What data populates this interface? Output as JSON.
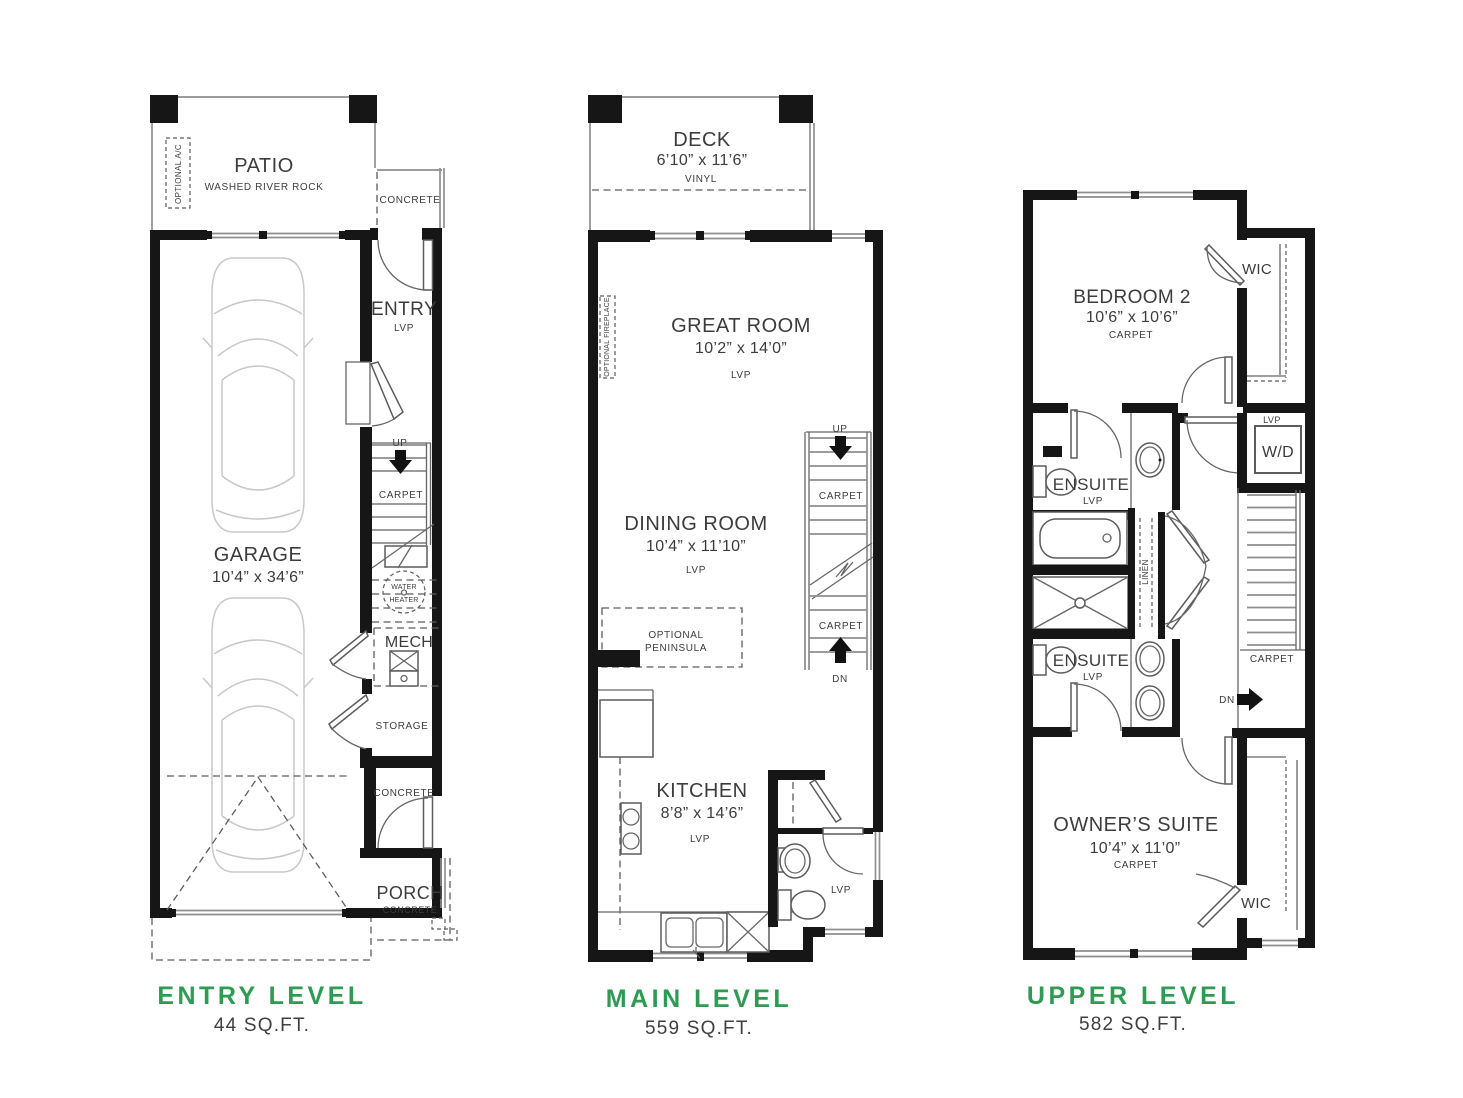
{
  "colors": {
    "accent_green": "#2e9b53",
    "ink": "#3c3c3c",
    "wall": "#161616",
    "thin_line": "#8f8f8f",
    "car_line": "#c8c8c8"
  },
  "entry": {
    "title": "ENTRY LEVEL",
    "area": "44 SQ.FT.",
    "patio": "PATIO",
    "patio_sub": "WASHED RIVER ROCK",
    "optional_ac": "OPTIONAL A/C",
    "concrete1": "CONCRETE",
    "entry": "ENTRY",
    "entry_floor": "LVP",
    "up": "UP",
    "carpet": "CARPET",
    "wh1": "WATER",
    "wh2": "HEATER",
    "mech": "MECH",
    "storage": "STORAGE",
    "garage": "GARAGE",
    "garage_dims": "10’4” x 34’6”",
    "concrete2": "CONCRETE",
    "porch": "PORCH",
    "porch_sub": "CONCRETE"
  },
  "main": {
    "title": "MAIN LEVEL",
    "area": "559 SQ.FT.",
    "deck": "DECK",
    "deck_dims": "6’10” x 11’6”",
    "deck_floor": "VINYL",
    "great": "GREAT ROOM",
    "great_dims": "10’2” x 14’0”",
    "great_floor": "LVP",
    "fireplace": "OPTIONAL FIREPLACE",
    "dining": "DINING ROOM",
    "dining_dims": "10’4” x 11’10”",
    "dining_floor": "LVP",
    "up": "UP",
    "dn": "DN",
    "carpet1": "CARPET",
    "carpet2": "CARPET",
    "pen1": "OPTIONAL",
    "pen2": "PENINSULA",
    "kitchen": "KITCHEN",
    "kitchen_dims": "8’8” x 14’6”",
    "kitchen_floor": "LVP",
    "powder_floor": "LVP"
  },
  "upper": {
    "title": "UPPER LEVEL",
    "area": "582 SQ.FT.",
    "bedroom2": "BEDROOM 2",
    "bedroom2_dims": "10’6” x 10’6”",
    "bedroom2_floor": "CARPET",
    "wic1": "WIC",
    "wd_floor": "LVP",
    "wd": "W/D",
    "ensuite1": "ENSUITE",
    "ensuite1_floor": "LVP",
    "linen": "LINEN",
    "stairs_carpet": "CARPET",
    "dn": "DN",
    "ensuite2": "ENSUITE",
    "ensuite2_floor": "LVP",
    "owners": "OWNER’S SUITE",
    "owners_dims": "10’4” x 11’0”",
    "owners_floor": "CARPET",
    "wic2": "WIC"
  }
}
